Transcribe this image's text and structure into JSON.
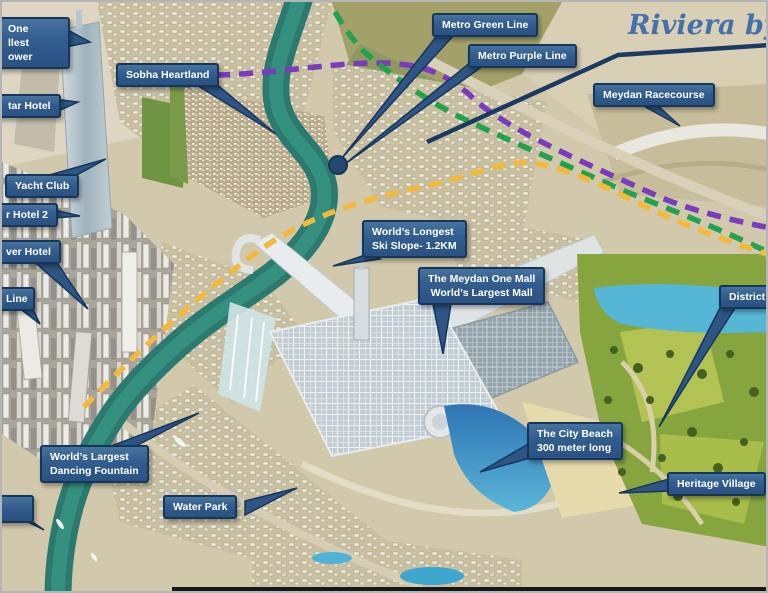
{
  "scene_description": "Annotated aerial masterplan render of Meydan One district, Dubai, with blue callout labels, dashed metro routes and park areas",
  "watermark": {
    "riviera_label": "Riviera by A"
  },
  "callouts": {
    "meydan_one_tower": {
      "lines": [
        "One",
        "llest",
        "ower"
      ],
      "cut": "left"
    },
    "star_hotel": {
      "label": "tar Hotel",
      "cut": "left"
    },
    "sobha_heartland": {
      "label": "Sobha Heartland"
    },
    "metro_green_line": {
      "label": "Metro Green Line"
    },
    "metro_purple_line": {
      "label": "Metro Purple Line"
    },
    "meydan_racecourse": {
      "label": "Meydan Racecourse"
    },
    "yacht_club": {
      "label": "Yacht Club"
    },
    "hotel_2": {
      "label": "r Hotel 2",
      "cut": "left"
    },
    "river_hotel": {
      "label": "ver Hotel",
      "cut": "left"
    },
    "line": {
      "label": "Line",
      "cut": "left"
    },
    "ski_slope": {
      "lines": [
        "World’s Longest",
        "Ski Slope- 1.2KM"
      ]
    },
    "meydan_one_mall": {
      "lines": [
        "The Meydan One Mall",
        "World’s Largest Mall"
      ]
    },
    "district_one": {
      "label": "District O",
      "cut": "right"
    },
    "dancing_fountain": {
      "lines": [
        "World’s Largest",
        "Dancing Fountain"
      ]
    },
    "city_beach": {
      "lines": [
        "The City Beach",
        "300 meter long"
      ]
    },
    "water_park": {
      "label": "Water Park"
    },
    "heritage_village": {
      "label": "Heritage Village"
    }
  },
  "map_colors": {
    "callout_fill": "#31598c",
    "callout_border": "#16365c",
    "callout_text": "#ffffff",
    "metro_green": "#22a14e",
    "metro_purple": "#7a3bbf",
    "route_yellow": "#f2b93d",
    "leader_navy": "#1b3a63",
    "riviera_blue": "#4470ac",
    "canal_teal": "#2c7a6f",
    "lake_cyan": "#56b6d6",
    "sand": "#d2c8ab",
    "park_green": "#86a53f"
  }
}
